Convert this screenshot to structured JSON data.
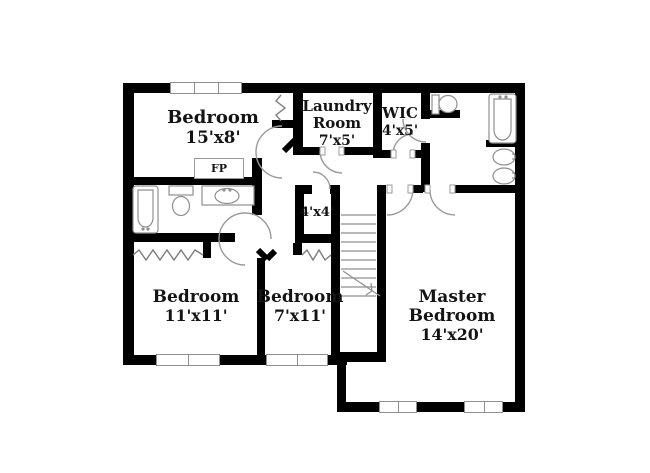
{
  "plan_title": "second floor plan",
  "rooms": {
    "bedroom_top": {
      "name": "Bedroom",
      "dims": "15'x8'"
    },
    "laundry": {
      "name": "Laundry Room",
      "dims": "7'x5'"
    },
    "wic": {
      "name": "WIC",
      "dims": "4'x5'"
    },
    "closet_4x4": {
      "dims": "4'x4'"
    },
    "bedroom_left": {
      "name": "Bedroom",
      "dims": "11'x11'"
    },
    "bedroom_mid": {
      "name": "Bedroom",
      "dims": "7'x11'"
    },
    "master": {
      "name": "Master Bedroom",
      "dims": "14'x20'"
    },
    "fireplace": {
      "label": "FP"
    }
  },
  "colors": {
    "wall": "#000000",
    "fixture_outline": "#8f8f8f",
    "door_arc": "#9a9a9a",
    "text": "#141414",
    "background": "#ffffff"
  }
}
